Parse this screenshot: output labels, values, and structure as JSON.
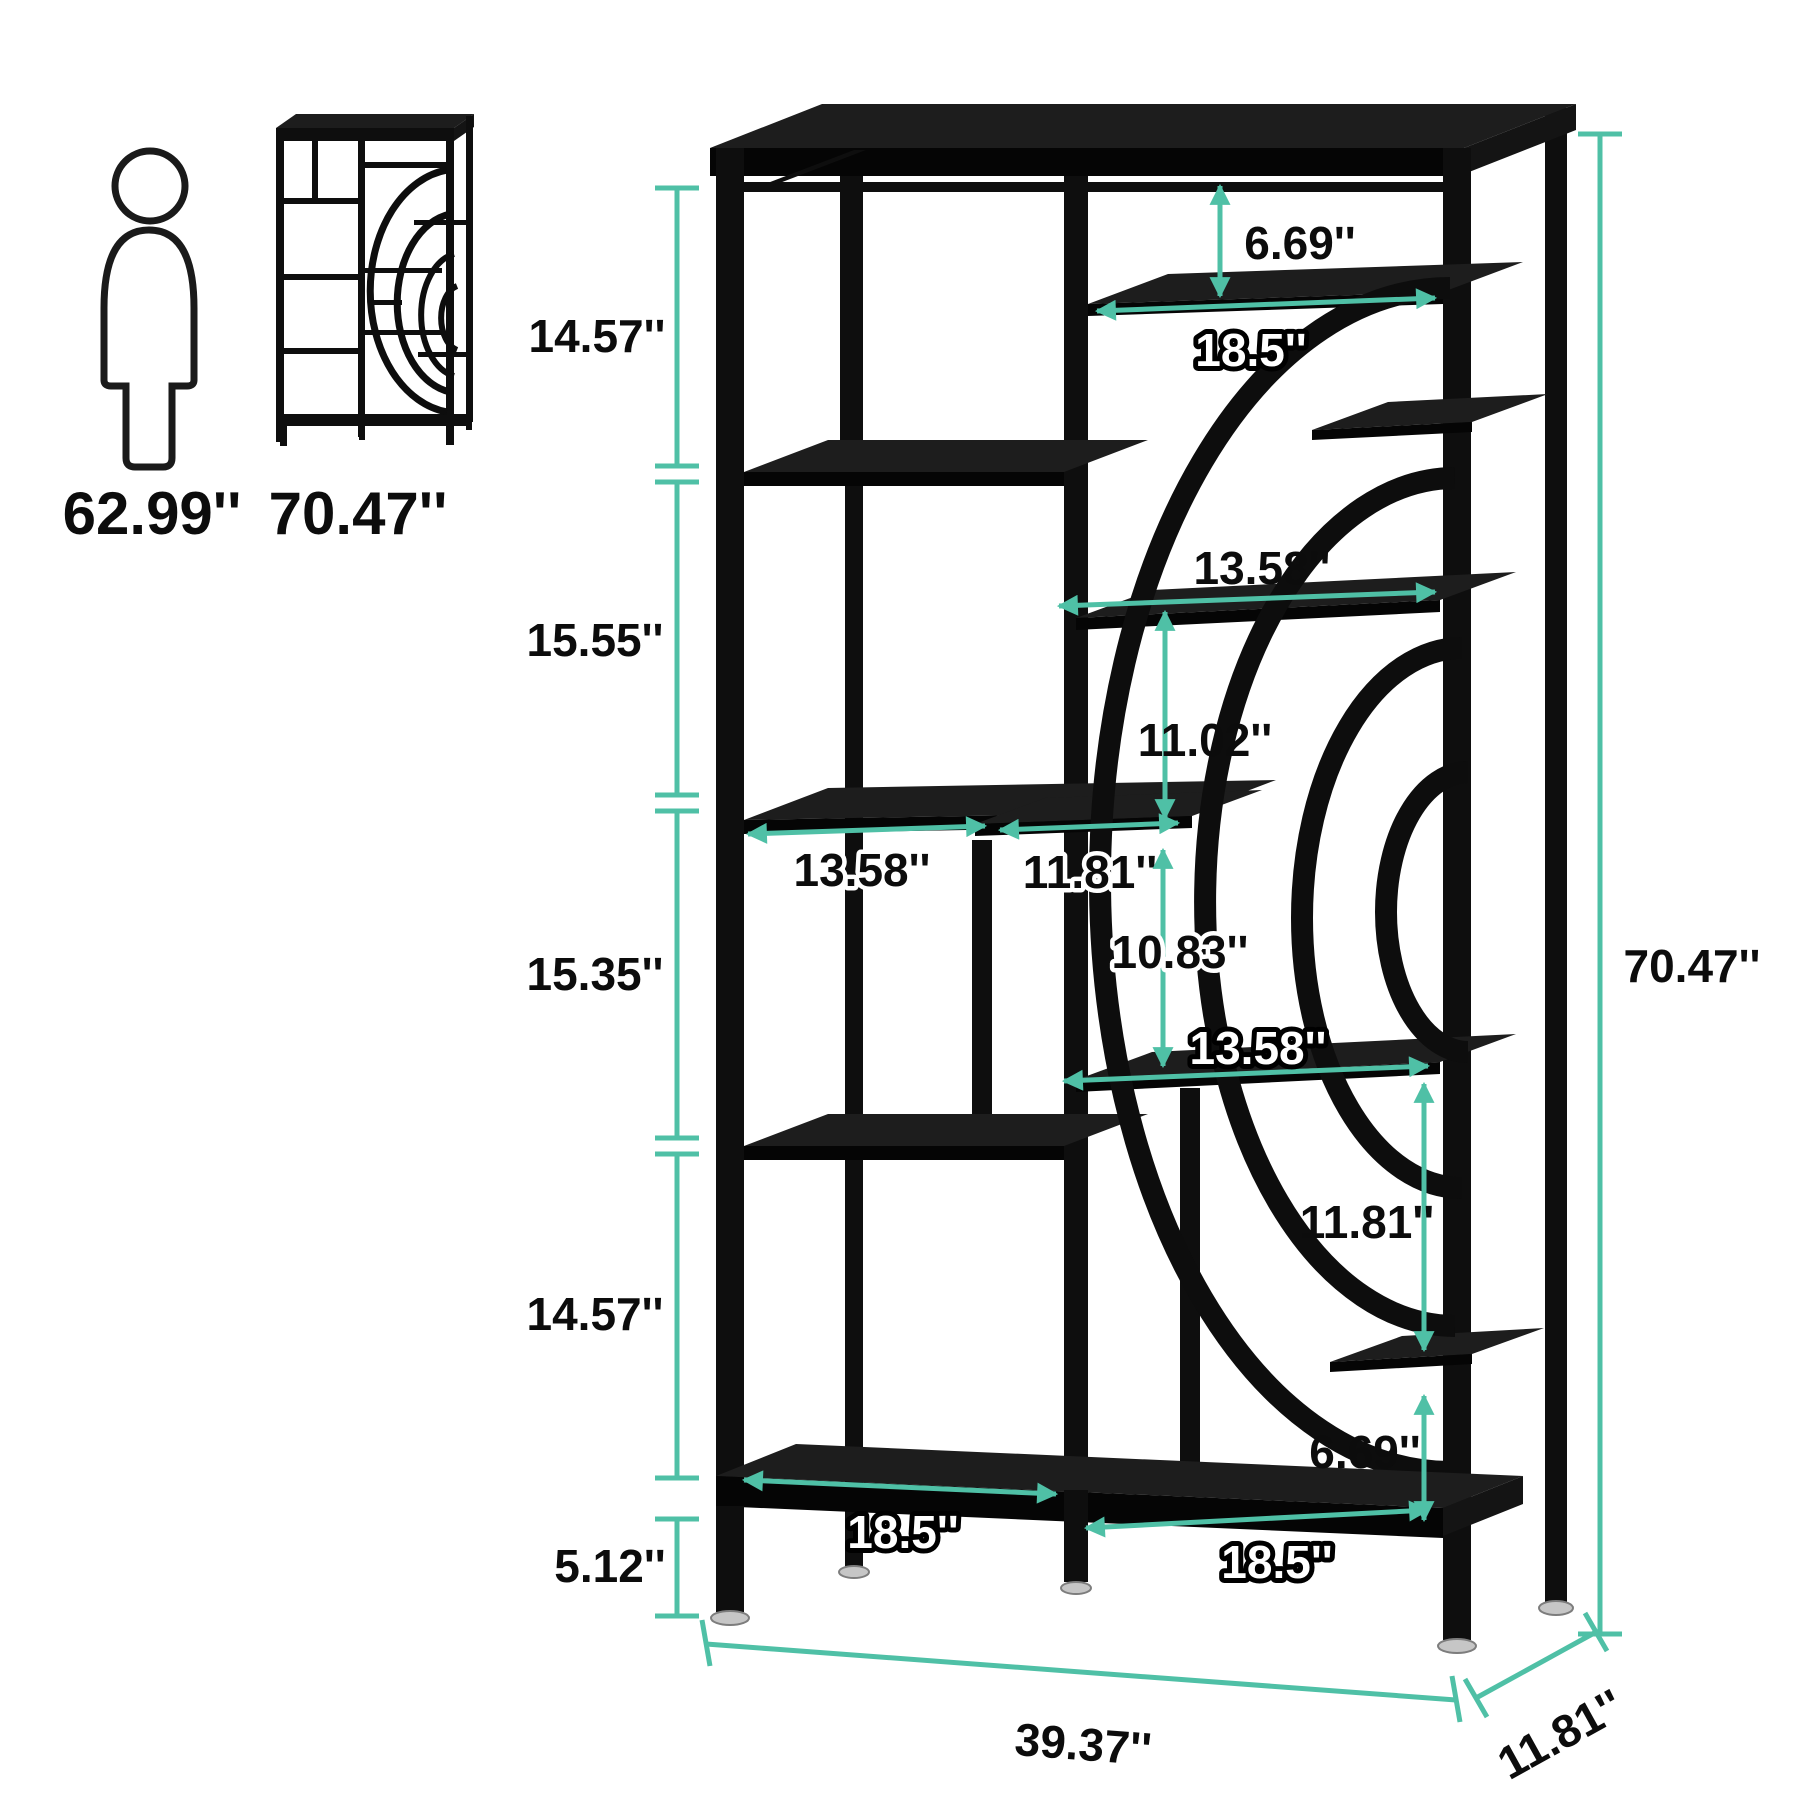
{
  "colors": {
    "accent": "#4FC0A6",
    "ink": "#0C0C0C"
  },
  "scale_reference": {
    "person_height": "62.99''",
    "bookcase_height": "70.47''"
  },
  "annotations": {
    "left_heights": {
      "section_1": "14.57''",
      "section_2": "15.55''",
      "section_3": "15.35''",
      "section_4": "14.57''",
      "base_height": "5.12''"
    },
    "overall": {
      "height": "70.47''",
      "width": "39.37''",
      "depth": "11.81''"
    },
    "shelves": {
      "top_clearance": "6.69''",
      "top_shelf_length": "18.5''",
      "upper_right_length": "13.58''",
      "upper_right_clearance": "11.02''",
      "middle_left_length": "13.58''",
      "middle_small_length": "11.81''",
      "middle_clearance": "10.83''",
      "lower_right_length": "13.58''",
      "lower_right_clearance": "11.81''",
      "base_clearance": "6.69''",
      "bottom_left_length": "18.5''",
      "bottom_right_length": "18.5''"
    }
  }
}
